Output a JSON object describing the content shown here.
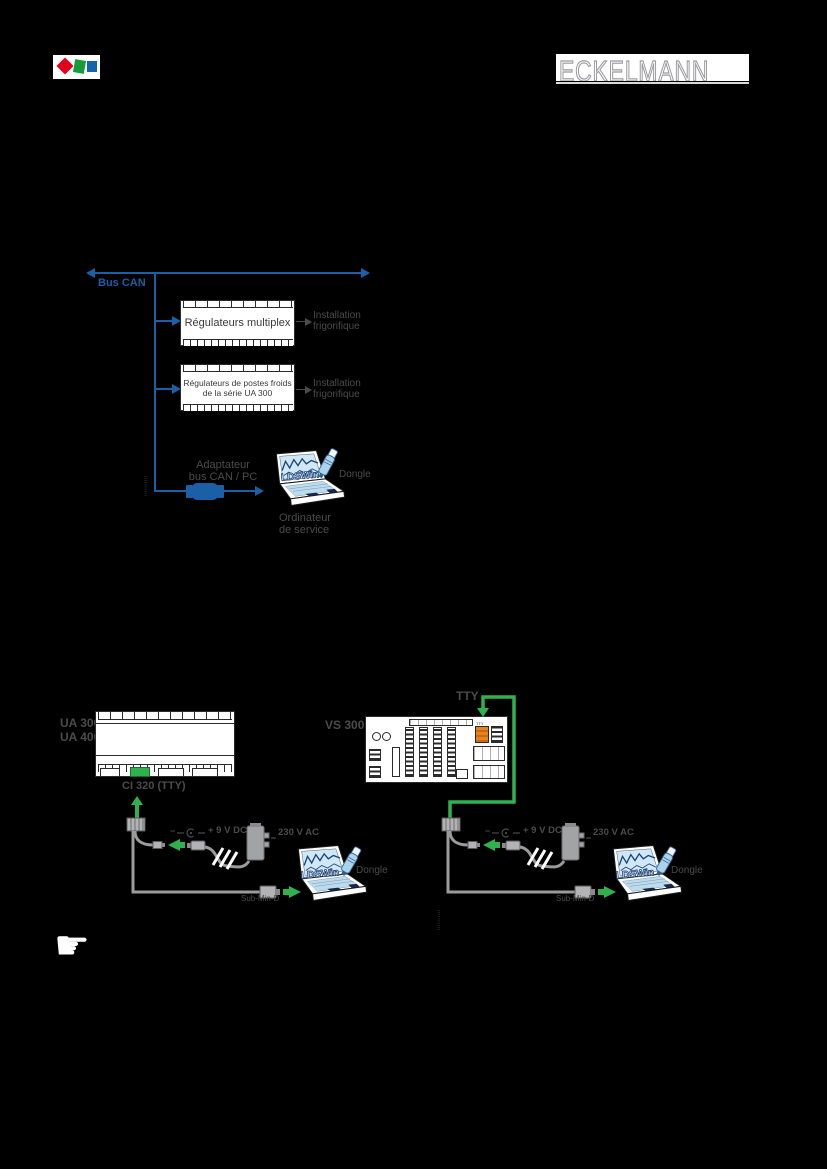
{
  "colors": {
    "bus_blue": "#1A5FA8",
    "wire_green": "#2FB24E",
    "label_gray": "#4B4B4D",
    "cable_gray": "#9B9B9D",
    "connector_orange": "#E8821E",
    "screen_blue": "#CFE7F6",
    "logo_red": "#E2001A",
    "logo_green": "#169C38",
    "logo_blue": "#1565AE"
  },
  "header": {
    "brand": "ECKELMANN"
  },
  "can_diagram": {
    "bus_label": "Bus CAN",
    "multiplex_box_label": "Régulateurs multiplex",
    "ua_box_line1": "Régulateurs de postes froids",
    "ua_box_line2": "de la série UA 300",
    "target_line1": "Installation",
    "target_line2": "frigorifique",
    "adapter_line1": "Adaptateur",
    "adapter_line2": "bus CAN / PC",
    "computer_line1": "Ordinateur",
    "computer_line2": "de service",
    "dongle_label": "Dongle",
    "screen_label": "LDSWin",
    "figure_id": "IIIIIIIIII"
  },
  "tty_diagram": {
    "left_device_line1": "UA 300",
    "left_device_line2": "UA 400",
    "ci_label": "CI 320 (TTY)",
    "vs_label": "VS 300",
    "tty_label": "TTY",
    "board_port_label": "TTY",
    "polarity_minus": "−",
    "dc_label": "+ 9 V DC",
    "ac_label": "230 V AC",
    "subd_label": "Sub-Min-D",
    "dongle_label": "Dongle",
    "screen_label": "LDSWin",
    "figure_id": "IIIIIIIIII"
  }
}
